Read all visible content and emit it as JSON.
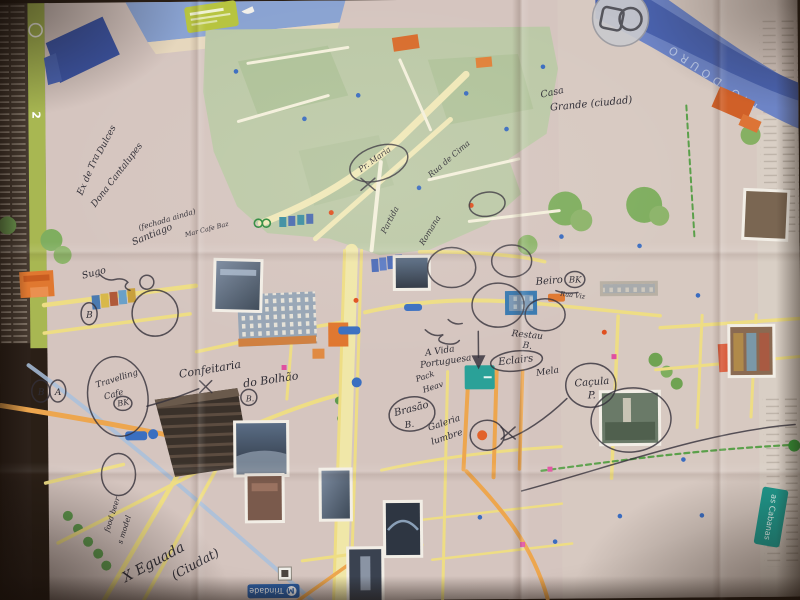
{
  "printed": {
    "panel_number": "2",
    "river_label": "RIO DOURO",
    "station_label": "Trindade",
    "metro_letter": "M",
    "cabanas_label": "as Cabanas"
  },
  "annotations": [
    "Dulces",
    "Ex de Tra",
    "Dona Cantalupes",
    "(fechada ainda)",
    "Santiago",
    "Mar Cafe Baz",
    "Sugo",
    "B",
    "Casa",
    "Grande (ciudad)",
    "Beiro",
    "BK",
    "Rua Viz",
    "Travelling",
    "Cafe",
    "BK",
    "B",
    "A",
    "Confeitaria",
    "do Bolhão",
    "B.",
    "A Vida",
    "Portuguesa",
    "Pack",
    "Heav",
    "Restau",
    "B.",
    "Eclairs",
    "Mela",
    "Caçula",
    "P.",
    "Brasão",
    "B.",
    "Galeria",
    "lumbre",
    "X Eguada",
    "(Ciudat)",
    "food beer",
    "s model",
    "Pr. Maria",
    "Rua de Cima",
    "Partida",
    "Romana"
  ],
  "colors": {
    "ink": "#33303a",
    "street_yellow": "#eedd84",
    "street_orange": "#eda64e",
    "old_town_green": "#bcc9a7",
    "river_blue": "#4a63b0",
    "teal_marker": "#2aa198",
    "metro_blue": "#2a5fa8"
  }
}
